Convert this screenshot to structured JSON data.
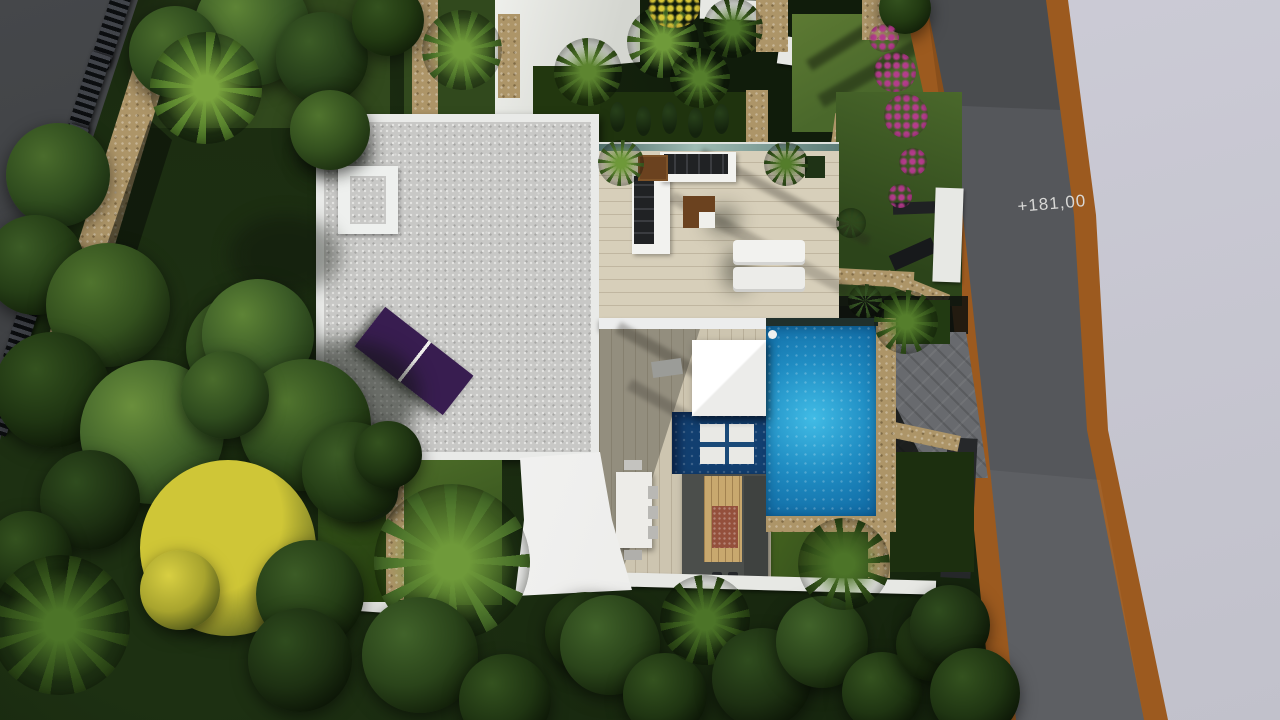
{
  "scene": {
    "elevation_label": "+181,00",
    "colors": {
      "road": "#55575b",
      "road_edge": "#9c5a1f",
      "terrain": "#cfced9",
      "terrain2": "#c1c1cb",
      "roof_gravel": "#c8c8c6",
      "parapet": "#e9eae8",
      "solar": "#381d50",
      "deck": "#d7cfba",
      "deck_lower": "#cdc5b0",
      "glass": "#5d7d78",
      "pool": "#1f8cc2",
      "pool_hi": "#41bce6",
      "pool_dk": "#0e649e",
      "pool_shallow": "#123f70",
      "stone": "#ad9568",
      "lawn": "#4a682b",
      "lawn_hi": "#5d7a33",
      "lawn_dk": "#31491d",
      "forest": "#101c0b",
      "forest2": "#1d3012",
      "white_wall": "#e7e8e4",
      "pavement_dark": "#3a3c3f",
      "fence_dark": "#0c0e10",
      "fence_mid": "#41444a",
      "kitchen": "#4b4e4b",
      "kitchen_wood": "#c8a86e",
      "bbq": "#94503c",
      "paver": "#686a6e",
      "sofa_dark": "#202224",
      "furn_white": "#f2f2ef",
      "table_brown": "#6b421f",
      "yellow_tree": "#cfc637",
      "bougainvillea": "#b43d8c",
      "label_text": "#d8d8d6"
    }
  }
}
